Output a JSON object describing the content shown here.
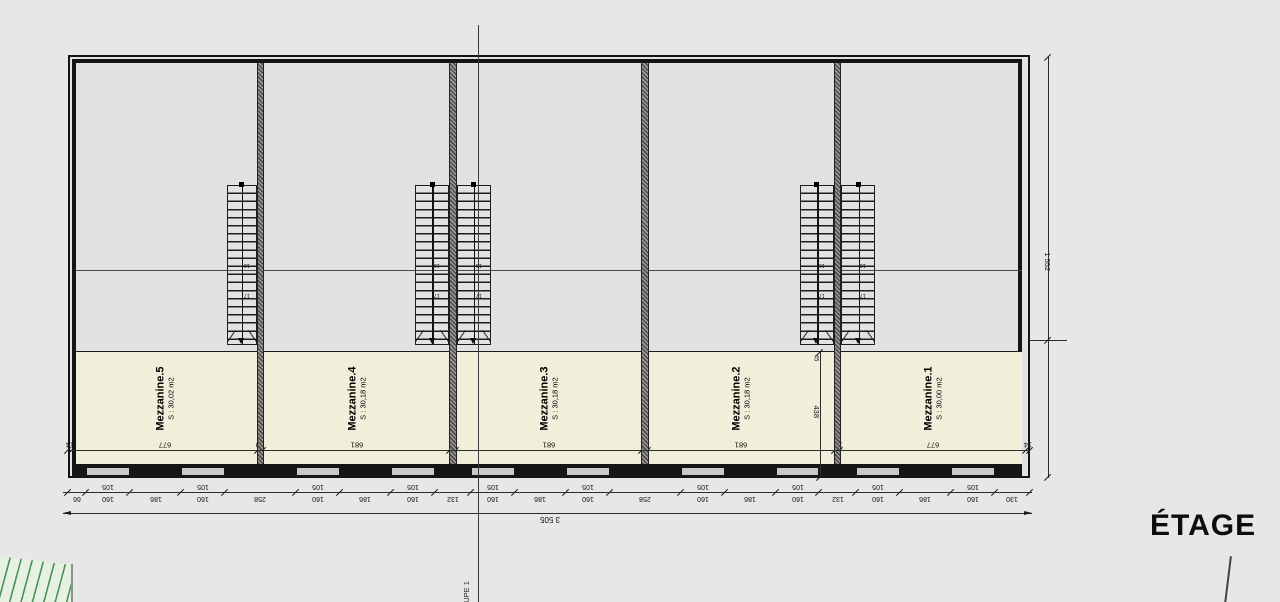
{
  "drawing": {
    "title": "ÉTAGE",
    "section_label": "COUPE 1",
    "rooms": [
      {
        "name": "Mezzanine.5",
        "area": "S : 30,02 m2"
      },
      {
        "name": "Mezzanine.4",
        "area": "S : 30,18 m2"
      },
      {
        "name": "Mezzanine.3",
        "area": "S : 30,18 m2"
      },
      {
        "name": "Mezzanine.2",
        "area": "S : 30,18 m2"
      },
      {
        "name": "Mezzanine.1",
        "area": "S : 30,00 m2"
      }
    ],
    "dimensions": {
      "total_width": "3 505",
      "total_height": "1 552",
      "window_row": [
        "105",
        "105",
        "105",
        "105",
        "105",
        "105",
        "105",
        "105",
        "105",
        "105"
      ],
      "bottom_chain": [
        "66",
        "160",
        "186",
        "160",
        "258",
        "160",
        "186",
        "160",
        "132",
        "160",
        "186",
        "160",
        "258",
        "160",
        "186",
        "160",
        "132",
        "160",
        "186",
        "160",
        "130"
      ],
      "interior_chain": [
        "14",
        "677",
        "20",
        "681",
        "20",
        "681",
        "20",
        "681",
        "20",
        "677",
        "14"
      ],
      "mezzanine_depth": "438",
      "mezzanine_edge": "45"
    },
    "stairs": {
      "step_labels": [
        "16",
        "17"
      ]
    }
  },
  "colors": {
    "wall": "#161616",
    "mezzanine_fill": "#f1efda",
    "hatch_green": "#4f9158",
    "background": "#e7e7e7"
  }
}
